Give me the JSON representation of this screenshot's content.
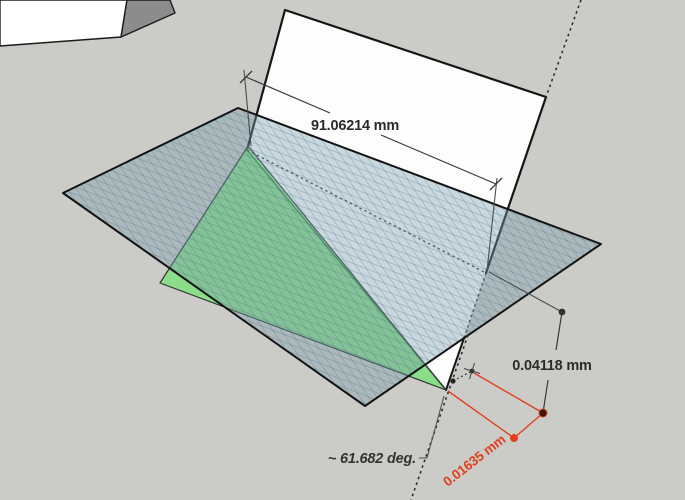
{
  "viewport": {
    "labels": {
      "edge_length": "91.06214 mm",
      "offset_distance": "0.04118 mm",
      "gap_distance": "0.01635 mm",
      "fold_angle": "~ 61.682 deg."
    },
    "colors": {
      "background": "#cbccc7",
      "white_face": "#fdfdfd",
      "background_object_light": "#ffffff",
      "background_object_dark": "#8c8c8c",
      "green_face": "#56eb56",
      "section_plane_fill": "#7a9eb0",
      "edge": "#161616",
      "dimension_line": "#4c4c4c",
      "dimension_text": "#2b2b2b",
      "accent_red": "#e0401f"
    }
  }
}
